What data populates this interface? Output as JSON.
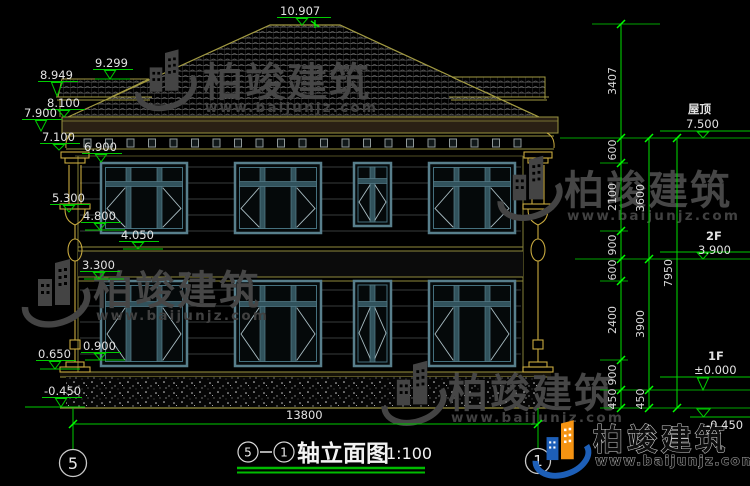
{
  "drawing_title": {
    "axis_left_bubble": "5",
    "axis_right_bubble": "1",
    "name": "轴立面图",
    "scale": "1:100"
  },
  "axes": {
    "left": "5",
    "right": "1"
  },
  "levels_left": [
    "10.907",
    "9.299",
    "8.949",
    "8.100",
    "7.900",
    "7.100",
    "6.900",
    "5.300",
    "4.800",
    "4.050",
    "3.300",
    "0.900",
    "0.650",
    "-0.450"
  ],
  "levels_right": [
    {
      "label": "屋顶",
      "value": "7.500"
    },
    {
      "label": "2F",
      "value": "3.900"
    },
    {
      "label": "1F",
      "value": "±0.000"
    },
    {
      "label": "",
      "value": "-0.450"
    }
  ],
  "dimensions": {
    "chain_inner": [
      "3407",
      "600",
      "2100",
      "900",
      "600",
      "2400",
      "900",
      "450"
    ],
    "chain_mid": [
      "3600",
      "3900",
      "450"
    ],
    "chain_outer": [
      "7950"
    ],
    "overall_width": "13800"
  },
  "watermark": {
    "brand": "柏竣建筑",
    "url": "www.baijunjz.com"
  },
  "colors": {
    "dim_green": "#00cc00",
    "tick_green": "#00ff00",
    "draw_olive": "#9a9440",
    "pilaster_gold": "#c7a93f",
    "window_teal": "#587f8c",
    "logo_blue": "#1d5fb8",
    "logo_orange": "#f59312"
  }
}
